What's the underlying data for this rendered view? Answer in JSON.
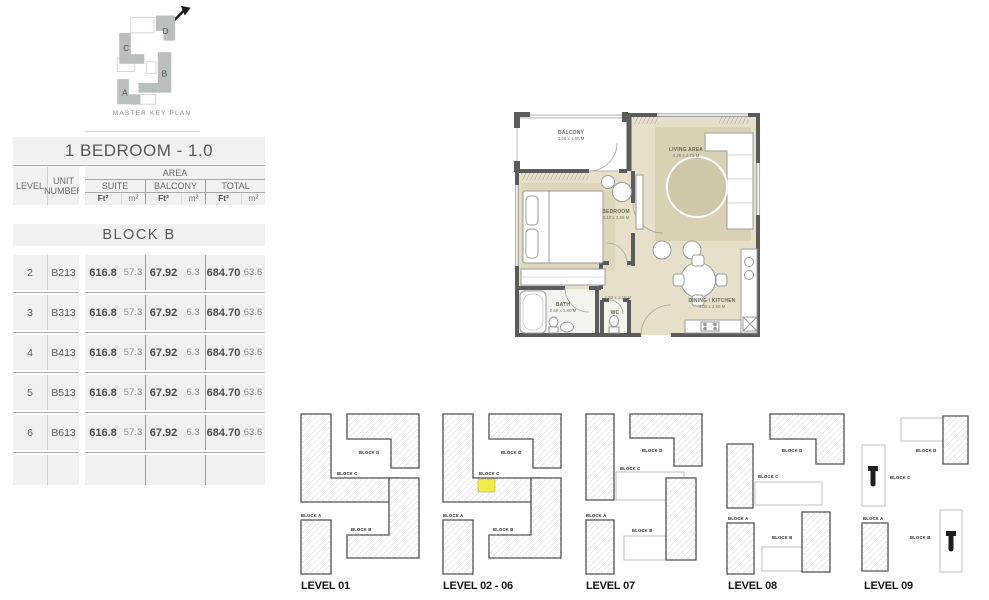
{
  "master_key_plan": {
    "caption": "MASTER KEY PLAN",
    "block_letters": [
      "D",
      "C",
      "B",
      "A"
    ]
  },
  "table": {
    "title": "1 BEDROOM - 1.0",
    "headers": {
      "level": "LEVEL",
      "unit": "UNIT NUMBER",
      "area": "AREA",
      "suite": "SUITE",
      "balcony": "BALCONY",
      "total": "TOTAL",
      "ft": "Ft²",
      "m": "m²"
    },
    "section": "BLOCK B",
    "rows": [
      {
        "level": "2",
        "unit": "B213",
        "suite_ft": "616.8",
        "suite_m": "57.3",
        "balcony_ft": "67.92",
        "balcony_m": "6.3",
        "total_ft": "684.70",
        "total_m": "63.6"
      },
      {
        "level": "3",
        "unit": "B313",
        "suite_ft": "616.8",
        "suite_m": "57.3",
        "balcony_ft": "67.92",
        "balcony_m": "6.3",
        "total_ft": "684.70",
        "total_m": "63.6"
      },
      {
        "level": "4",
        "unit": "B413",
        "suite_ft": "616.8",
        "suite_m": "57.3",
        "balcony_ft": "67.92",
        "balcony_m": "6.3",
        "total_ft": "684.70",
        "total_m": "63.6"
      },
      {
        "level": "5",
        "unit": "B513",
        "suite_ft": "616.8",
        "suite_m": "57.3",
        "balcony_ft": "67.92",
        "balcony_m": "6.3",
        "total_ft": "684.70",
        "total_m": "63.6"
      },
      {
        "level": "6",
        "unit": "B613",
        "suite_ft": "616.8",
        "suite_m": "57.3",
        "balcony_ft": "67.92",
        "balcony_m": "6.3",
        "total_ft": "684.70",
        "total_m": "63.6"
      }
    ]
  },
  "floor_plan": {
    "rooms": [
      {
        "name": "BALCONY",
        "dims": "3.66 x 1.66 M"
      },
      {
        "name": "LIVING AREA",
        "dims": "4.28 x 4.75 M"
      },
      {
        "name": "BEDROOM",
        "dims": "4.10 x 3.65 M"
      },
      {
        "name": "BATH",
        "dims": "2.60 x 1.80 M"
      },
      {
        "name": "",
        "dims": "1.52 x 1.10 M"
      },
      {
        "name": "DINING / KITCHEN",
        "dims": "4.00 x 3.50 M"
      },
      {
        "name": "WC",
        "dims": ""
      }
    ]
  },
  "levels": [
    {
      "caption": "LEVEL 01",
      "blocks": [
        "BLOCK D",
        "BLOCK C",
        "BLOCK A",
        "BLOCK B"
      ],
      "highlight": false
    },
    {
      "caption": "LEVEL 02 - 06",
      "blocks": [
        "BLOCK D",
        "BLOCK C",
        "BLOCK A",
        "BLOCK B"
      ],
      "highlight": true
    },
    {
      "caption": "LEVEL 07",
      "blocks": [
        "BLOCK D",
        "BLOCK C",
        "BLOCK A",
        "BLOCK B"
      ],
      "highlight": false
    },
    {
      "caption": "LEVEL 08",
      "blocks": [
        "BLOCK D",
        "BLOCK C",
        "BLOCK A",
        "BLOCK B"
      ],
      "highlight": false
    },
    {
      "caption": "LEVEL 09",
      "blocks": [
        "BLOCK D",
        "BLOCK C",
        "BLOCK A",
        "BLOCK B"
      ],
      "highlight": false
    }
  ],
  "colors": {
    "highlight": "#f2eb4e",
    "floor": "#e6e0cb",
    "rug": "#d9d1b4",
    "wall": "#5b5b5b",
    "mkp_block": "#b9c0bc"
  }
}
